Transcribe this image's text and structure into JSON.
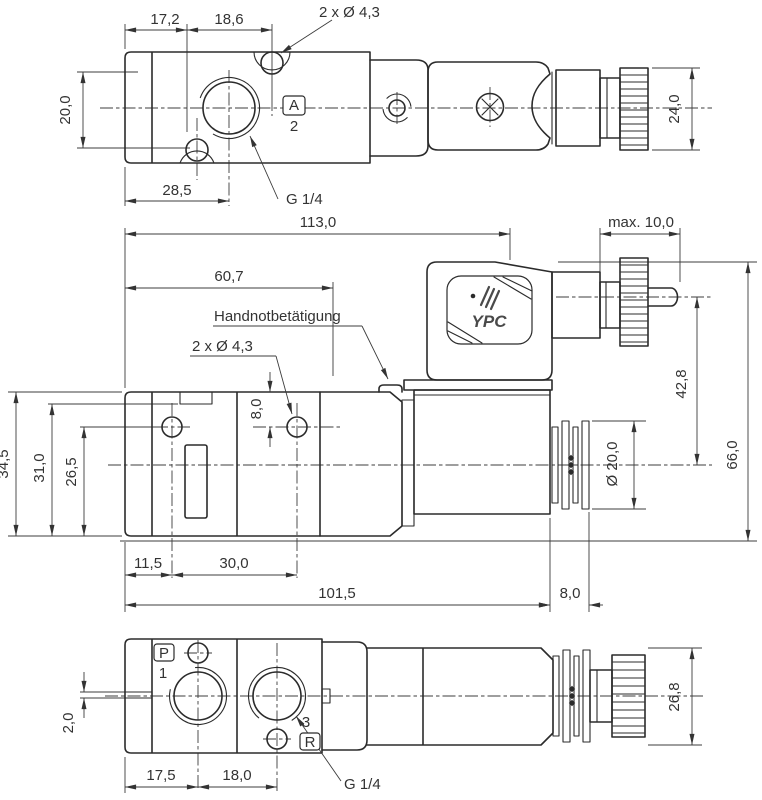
{
  "drawing": {
    "brand": "YPC",
    "colors": {
      "ink": "#2b2b2b",
      "dim": "#3c3c3c",
      "background": "#ffffff",
      "logo": "#4a4a4a"
    },
    "views": {
      "top": {
        "dim_17_2": "17,2",
        "dim_18_6": "18,6",
        "callout_holes": "2 x Ø 4,3",
        "dim_20_0": "20,0",
        "dim_28_5": "28,5",
        "port_letter": "A",
        "port_number": "2",
        "callout_thread": "G 1/4",
        "dim_24_0": "24,0"
      },
      "front": {
        "dim_113_0": "113,0",
        "dim_max_10": "max. 10,0",
        "dim_60_7": "60,7",
        "label_manual_override": "Handnotbetätigung",
        "callout_holes": "2 x Ø 4,3",
        "dim_8_0_hole": "8,0",
        "dim_34_5": "34,5",
        "dim_31_0": "31,0",
        "dim_26_5": "26,5",
        "dim_42_8": "42,8",
        "dim_66_0": "66,0",
        "dim_dia_20_0": "Ø 20,0",
        "dim_11_5": "11,5",
        "dim_30_0": "30,0",
        "dim_101_5": "101,5",
        "dim_8_0_end": "8,0"
      },
      "bottom": {
        "port_p_letter": "P",
        "port_p_number": "1",
        "dim_2_0": "2,0",
        "port_r_number": "3",
        "port_r_letter": "R",
        "dim_17_5": "17,5",
        "dim_18_0": "18,0",
        "callout_thread": "G 1/4",
        "dim_26_8": "26,8"
      }
    }
  }
}
